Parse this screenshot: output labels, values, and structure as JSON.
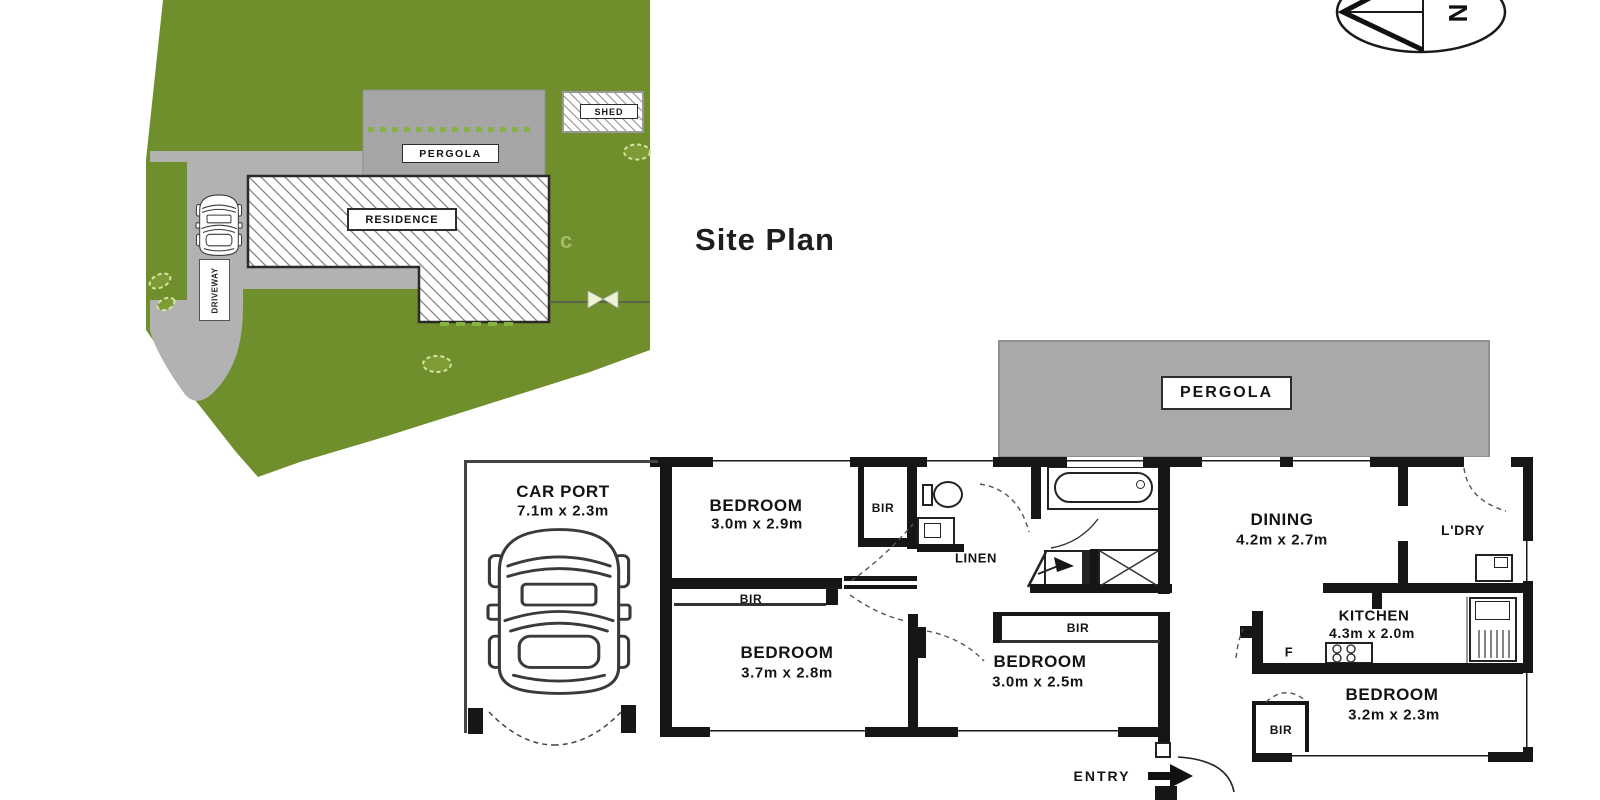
{
  "titles": {
    "site_plan": "Site Plan"
  },
  "compass": {
    "north": "N"
  },
  "site_plan": {
    "residence": "RESIDENCE",
    "pergola": "PERGOLA",
    "shed": "SHED",
    "driveway": "DRIVEWAY",
    "mark": "c",
    "colors": {
      "grass": "#6f8f2c",
      "paving": "#b2b2b2",
      "pergola_gray": "#a6a6a6"
    }
  },
  "floor_plan": {
    "pergola": "PERGOLA",
    "entry": "ENTRY",
    "linen": "LINEN",
    "fridge": "F",
    "laundry": "L'DRY",
    "carport": {
      "name": "CAR PORT",
      "dims": "7.1m x 2.3m"
    },
    "bedroom1": {
      "name": "BEDROOM",
      "dims": "3.0m x 2.9m"
    },
    "bedroom2": {
      "name": "BEDROOM",
      "dims": "3.7m x 2.8m"
    },
    "bedroom3": {
      "name": "BEDROOM",
      "dims": "3.0m x 2.5m"
    },
    "bedroom4": {
      "name": "BEDROOM",
      "dims": "3.2m x 2.3m"
    },
    "dining": {
      "name": "DINING",
      "dims": "4.2m x 2.7m"
    },
    "kitchen": {
      "name": "KITCHEN",
      "dims": "4.3m x 2.0m"
    },
    "bir1": "BIR",
    "bir2": "BIR",
    "bir3": "BIR",
    "bir4": "BIR",
    "wall_color": "#161616"
  },
  "icons": [
    "compass-north-icon",
    "car-top-view-icon",
    "bush-icon",
    "gate-icon",
    "toilet-icon",
    "bath-icon",
    "shower-icon",
    "basin-icon",
    "laundry-trough-icon",
    "kitchen-sink-icon",
    "cooktop-icon",
    "entry-arrow-icon",
    "door-swing-arc"
  ]
}
